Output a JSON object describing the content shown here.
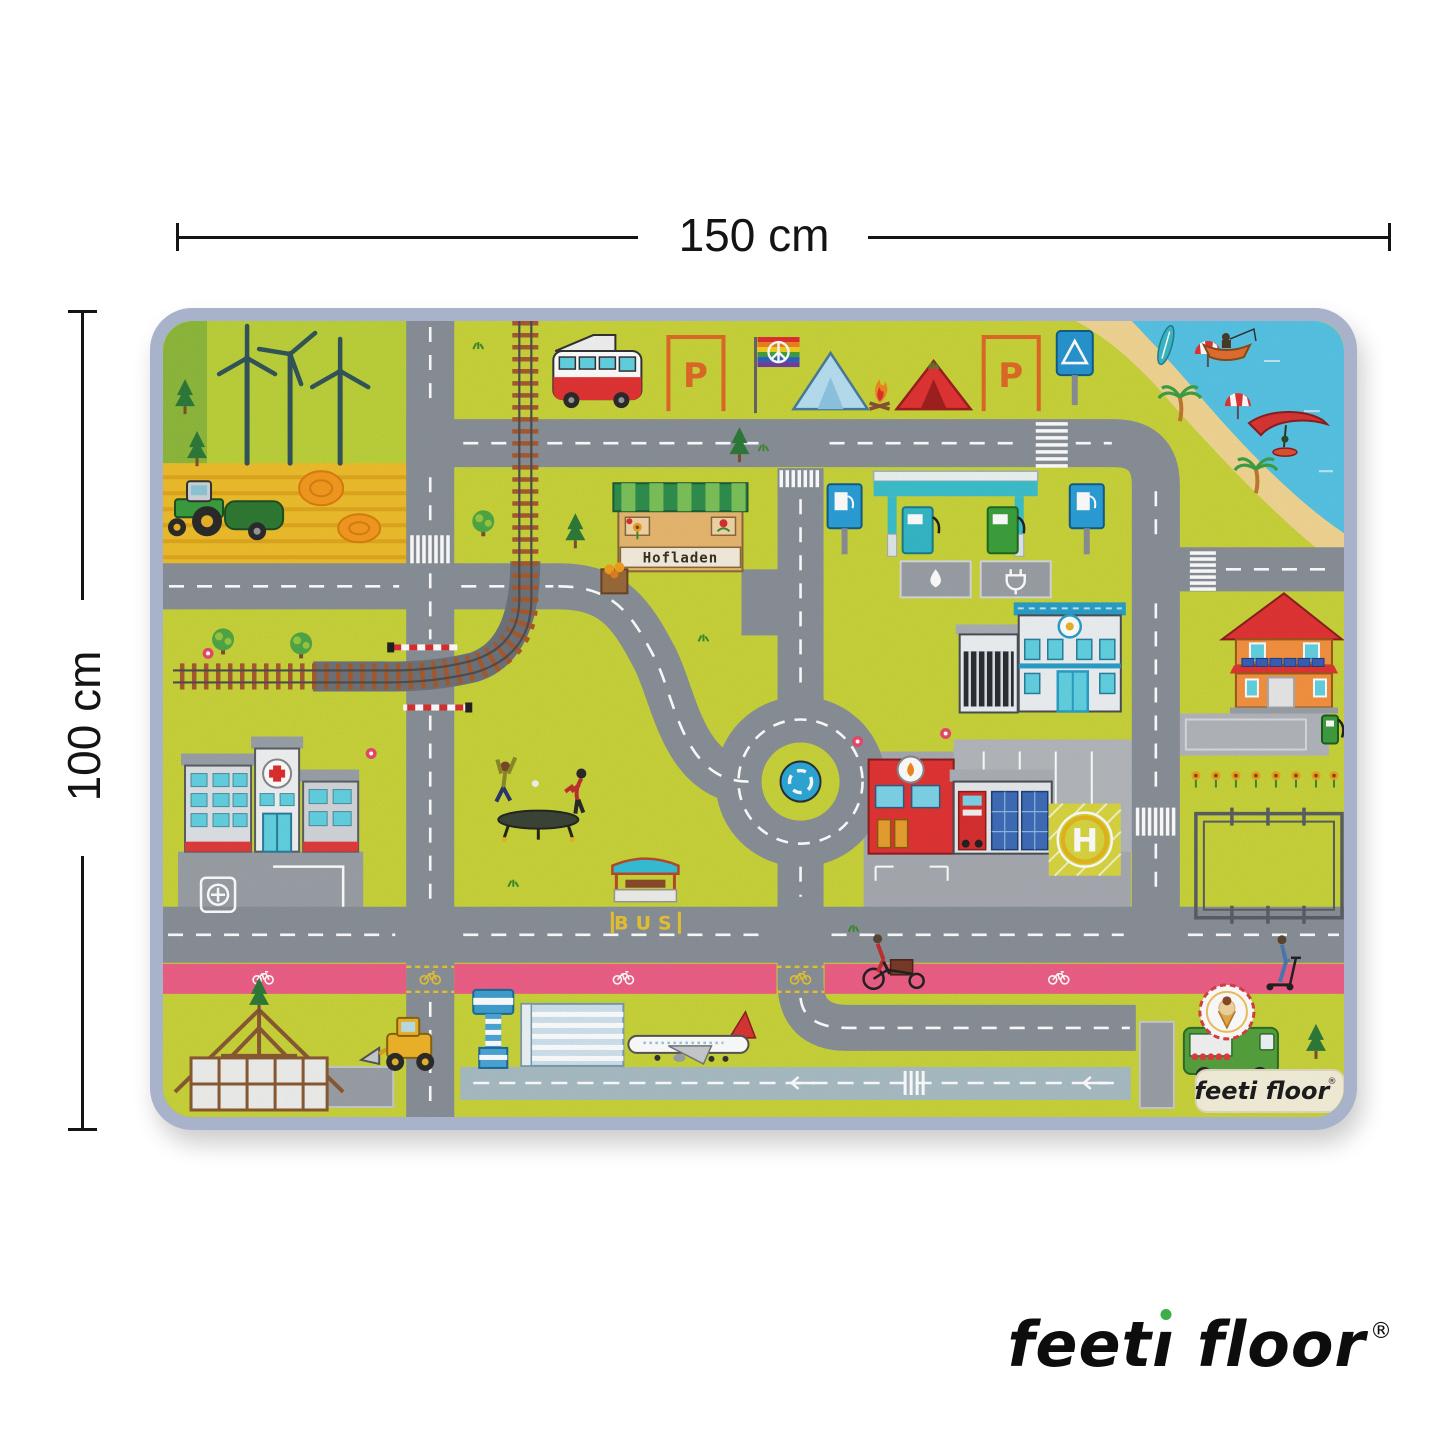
{
  "dimension_top": {
    "label": "150 cm"
  },
  "dimension_left": {
    "label": "100 cm"
  },
  "brand_logo": {
    "name": "feeti floor",
    "display_pre": "feet",
    "display_dotless_i": "ı",
    "display_post": " floor",
    "registered_mark": "®",
    "dot_color": "#3fae4a"
  },
  "rug": {
    "border_color": "#a9b2cb",
    "base_color": "#c9d43a",
    "texts": {
      "farm_shop_sign": "Hofladen",
      "bus_stop_marking": "BUS",
      "helipad_letter": "H",
      "parking_label_1": "P",
      "parking_label_2": "P"
    },
    "label_badge": {
      "text": "feeti floor",
      "registered_mark": "®"
    },
    "colors": {
      "road": "#8a9098",
      "bike_lane": "#ee5f86",
      "sea": "#57c4e6",
      "sand": "#f2d694",
      "wheat_field": "#efbe2c",
      "runway": "#a9bdc5",
      "railway_ties": "#a85a2e",
      "hospital_cross": "#dd2f2f",
      "fire_station_red": "#e23434",
      "police_trim_blue": "#2a9fc8",
      "house_orange": "#f59240",
      "gas_canopy_teal": "#3cc0cc"
    },
    "features": [
      "wind-turbines",
      "tractor",
      "hay-bales",
      "wheat-field",
      "pine-trees",
      "railway",
      "level-crossing",
      "camper-van",
      "parking-bays",
      "rainbow-peace-flag",
      "tents",
      "campfire",
      "camping-sign",
      "beach",
      "surfboard",
      "beach-umbrellas",
      "fishing-boat",
      "windsurfer",
      "palm-trees",
      "gas-station",
      "car-wash-pad",
      "ev-charging-pad",
      "farm-shop",
      "hospital",
      "ambulance-parking",
      "trampoline-kids",
      "bus-stop",
      "roundabout",
      "police-station",
      "fire-station",
      "helipad",
      "family-house",
      "solar-panels",
      "ev-charger",
      "sunflowers",
      "paddock",
      "main-road",
      "bike-lane",
      "cargo-bike-rider",
      "scooter-rider",
      "construction-timber-house",
      "wheel-loader",
      "airport-control-tower",
      "airport-terminal",
      "airplane",
      "runway",
      "ice-cream-truck"
    ]
  }
}
